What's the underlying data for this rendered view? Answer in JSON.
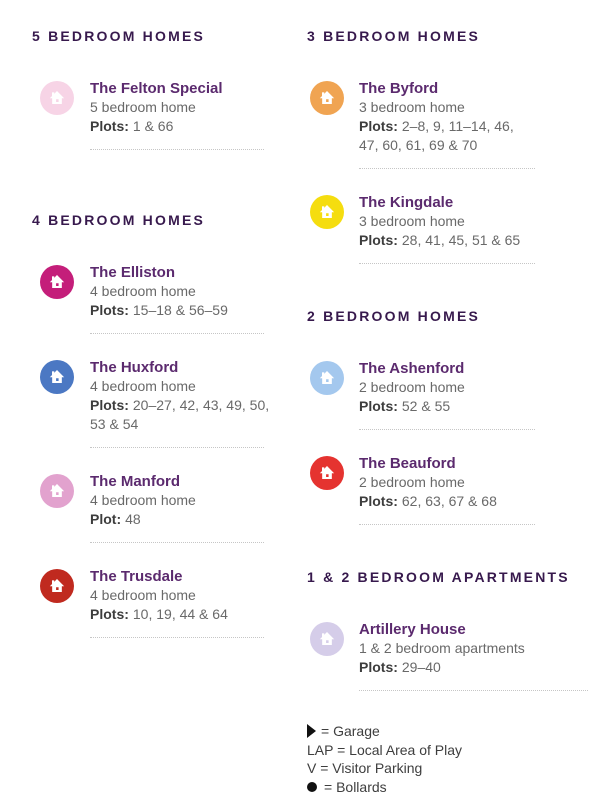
{
  "left": {
    "sections": [
      {
        "heading": "5 BEDROOM HOMES",
        "cards": [
          {
            "name": "The Felton Special",
            "type": "5 bedroom home",
            "plots_label": "Plots:",
            "plots": "1 & 66",
            "color": "#F7D4E6"
          }
        ]
      },
      {
        "heading": "4 BEDROOM HOMES",
        "cards": [
          {
            "name": "The Elliston",
            "type": "4 bedroom home",
            "plots_label": "Plots:",
            "plots": "15–18 & 56–59",
            "color": "#C41E7A"
          },
          {
            "name": "The Huxford",
            "type": "4 bedroom home",
            "plots_label": "Plots:",
            "plots": "20–27, 42, 43, 49, 50, 53 & 54",
            "color": "#4B78C3"
          },
          {
            "name": "The Manford",
            "type": "4 bedroom home",
            "plots_label": "Plot:",
            "plots": "48",
            "color": "#E2A2CE"
          },
          {
            "name": "The Trusdale",
            "type": "4 bedroom home",
            "plots_label": "Plots:",
            "plots": "10, 19, 44 & 64",
            "color": "#C02A1F"
          }
        ]
      }
    ]
  },
  "right": {
    "sections": [
      {
        "heading": "3 BEDROOM HOMES",
        "cards": [
          {
            "name": "The Byford",
            "type": "3 bedroom home",
            "plots_label": "Plots:",
            "plots": "2–8, 9, 11–14, 46, 47, 60, 61, 69 & 70",
            "color": "#F0A452"
          },
          {
            "name": "The Kingdale",
            "type": "3 bedroom home",
            "plots_label": "Plots:",
            "plots": "28, 41, 45, 51 & 65",
            "color": "#F5DD0F"
          }
        ]
      },
      {
        "heading": "2 BEDROOM HOMES",
        "cards": [
          {
            "name": "The Ashenford",
            "type": "2 bedroom home",
            "plots_label": "Plots:",
            "plots": "52 & 55",
            "color": "#A4C8EE"
          },
          {
            "name": "The Beauford",
            "type": "2 bedroom home",
            "plots_label": "Plots:",
            "plots": "62, 63, 67 & 68",
            "color": "#E53330"
          }
        ]
      },
      {
        "heading": "1 & 2 BEDROOM APARTMENTS",
        "cards": [
          {
            "name": "Artillery House",
            "type": "1 & 2 bedroom apartments",
            "plots_label": "Plots:",
            "plots": "29–40",
            "color": "#D5CDE9"
          }
        ]
      }
    ]
  },
  "legend": {
    "rows": [
      {
        "symbol": "garage-triangle",
        "label": "= Garage"
      },
      {
        "symbol": "none",
        "label": "LAP = Local Area of Play"
      },
      {
        "symbol": "none",
        "label": "V = Visitor Parking"
      },
      {
        "symbol": "bollard-dot",
        "label": "= Bollards"
      }
    ]
  }
}
